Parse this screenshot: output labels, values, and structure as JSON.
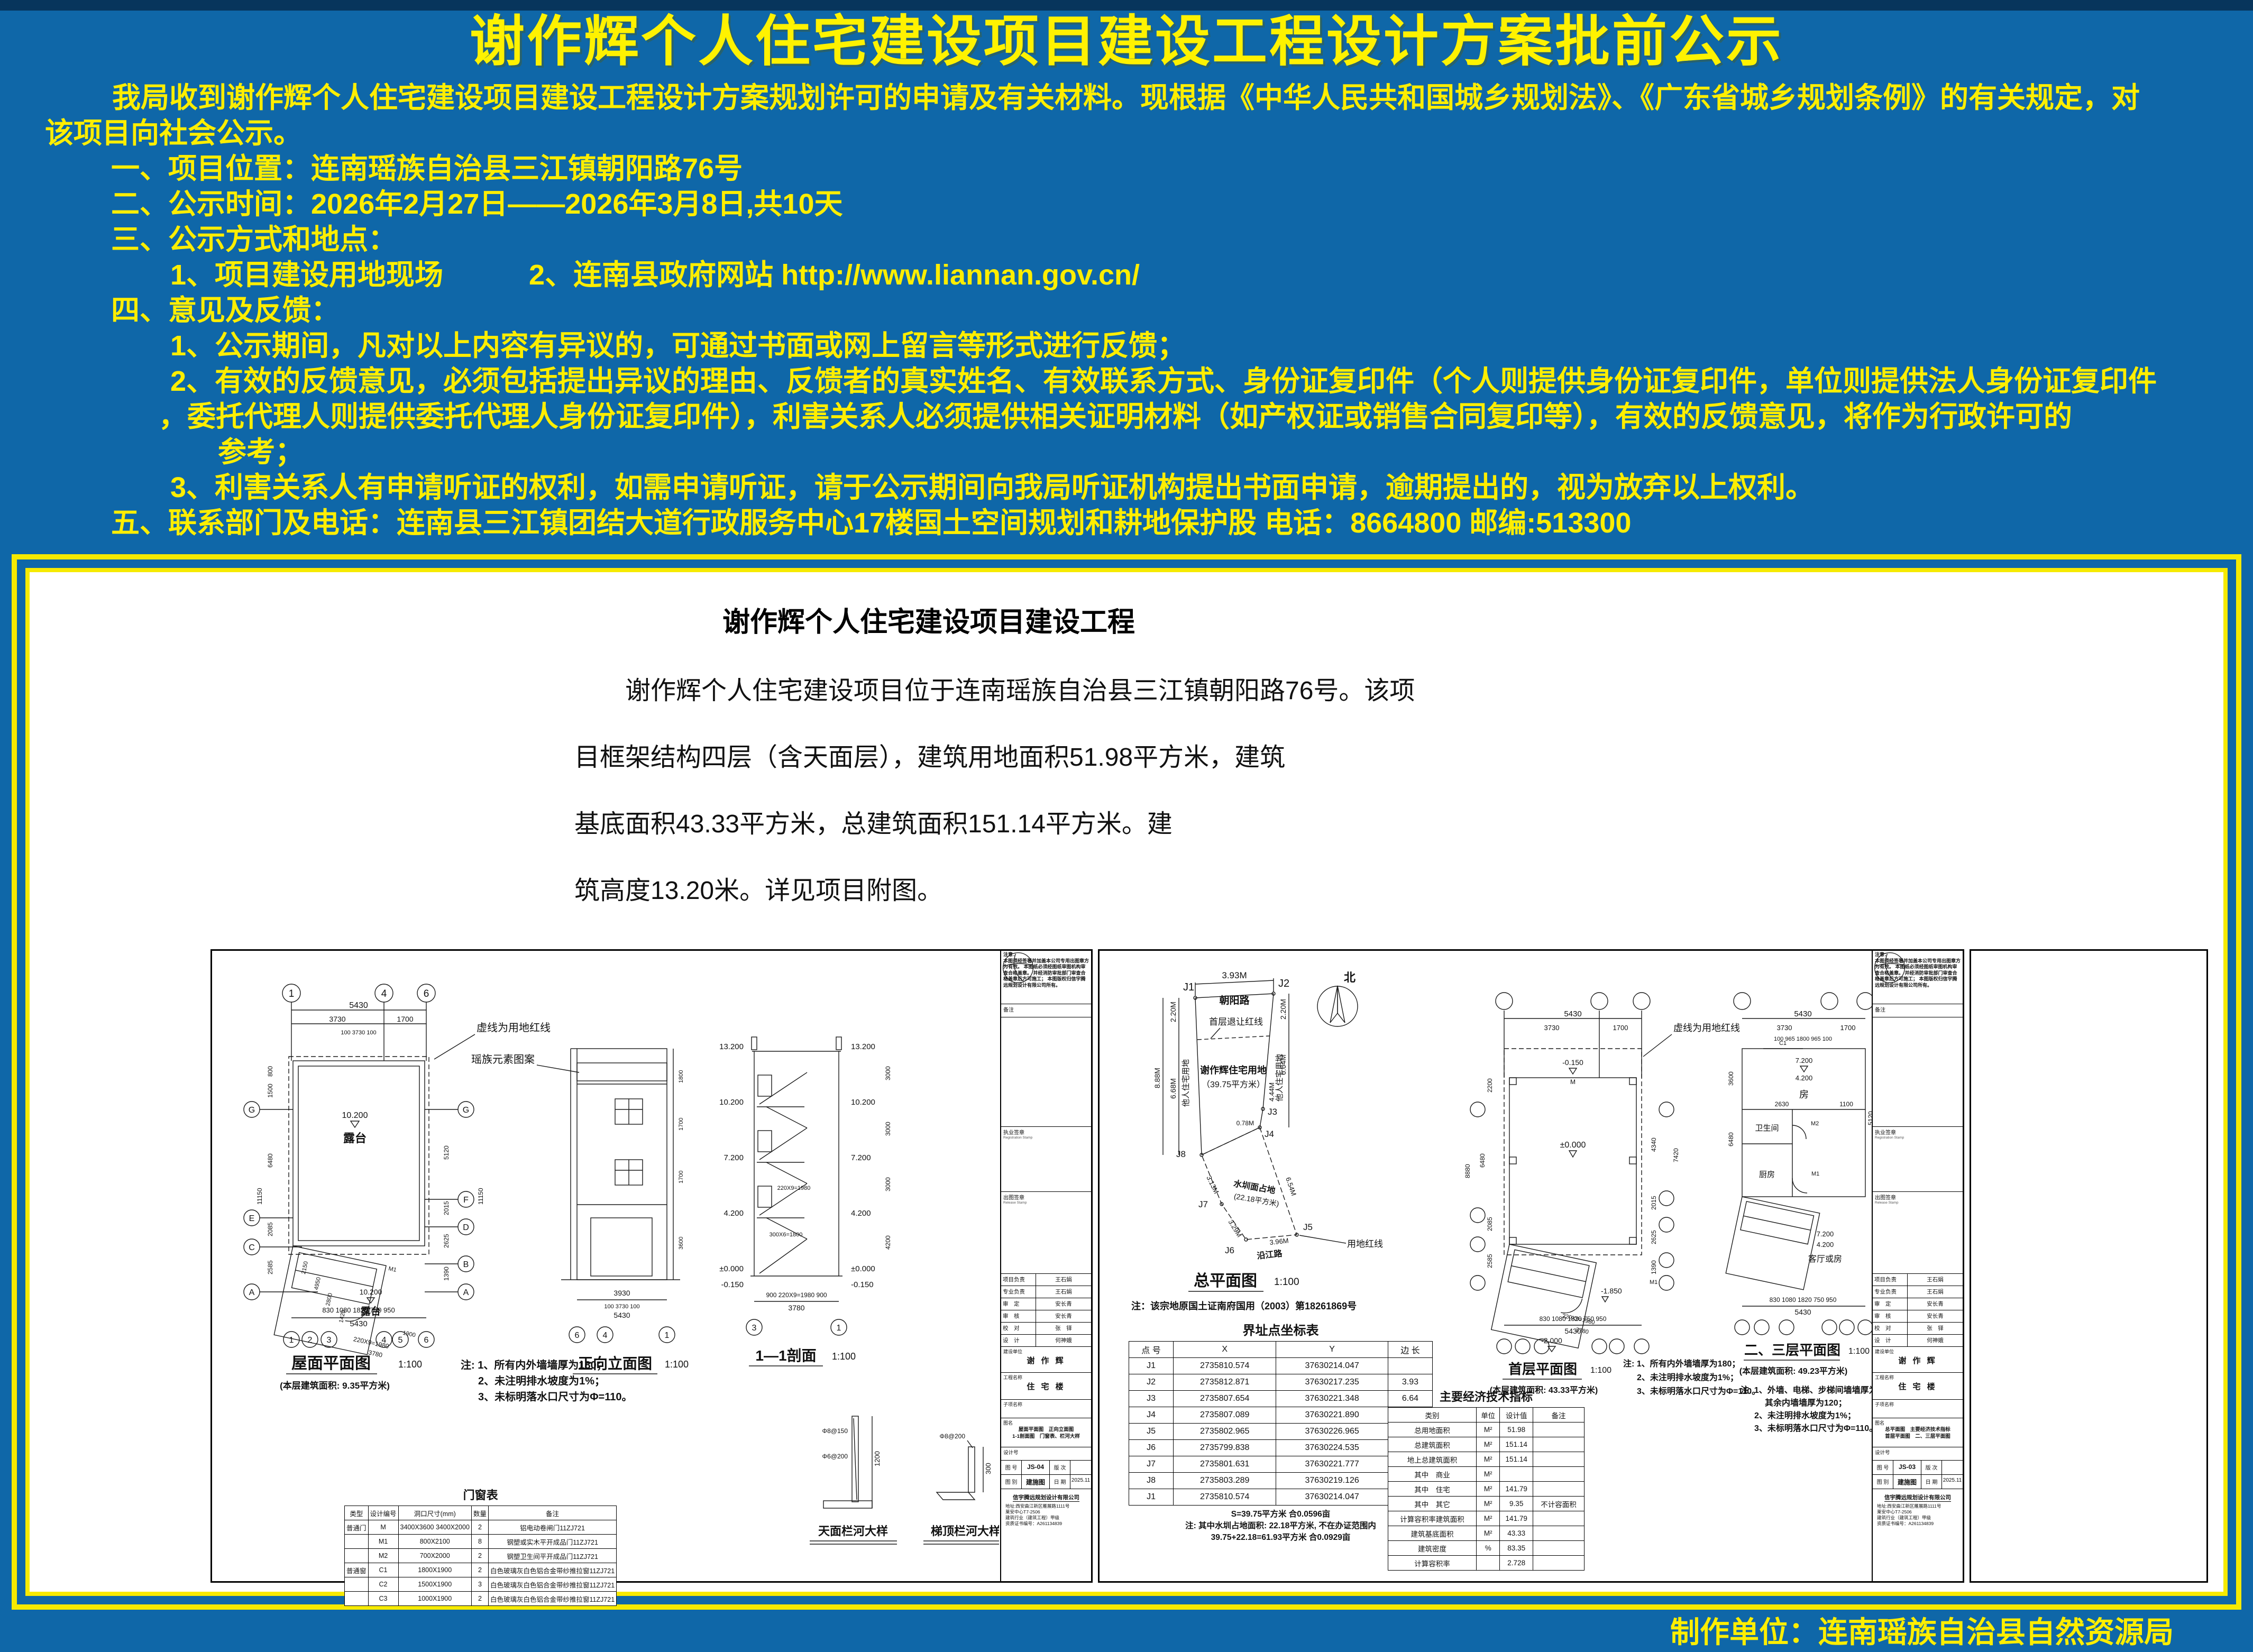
{
  "header": {
    "title": "谢作辉个人住宅建设项目建设工程设计方案批前公示",
    "lines": [
      "我局收到谢作辉个人住宅建设项目建设工程设计方案规划许可的申请及有关材料。现根据《中华人民共和国城乡规划法》、《广东省城乡规划条例》的有关规定，对",
      "该项目向社会公示。",
      "一、项目位置：连南瑶族自治县三江镇朝阳路76号",
      "二、公示时间：2026年2月27日——2026年3月8日,共10天",
      "三、公示方式和地点：",
      "1、项目建设用地现场　　　2、连南县政府网站 http://www.liannan.gov.cn/",
      "四、意见及反馈：",
      "1、公示期间，凡对以上内容有异议的，可通过书面或网上留言等形式进行反馈；",
      "2、有效的反馈意见，必须包括提出异议的理由、反馈者的真实姓名、有效联系方式、身份证复印件（个人则提供身份证复印件，单位则提供法人身份证复印件",
      "，委托代理人则提供委托代理人身份证复印件），利害关系人必须提供相关证明材料（如产权证或销售合同复印等），有效的反馈意见，将作为行政许可的",
      "参考；",
      "3、利害关系人有申请听证的权利，如需申请听证，请于公示期间向我局听证机构提出书面申请，逾期提出的，视为放弃以上权利。",
      "五、联系部门及电话：连南县三江镇团结大道行政服务中心17楼国土空间规划和耕地保护股 电话：8664800 邮编:513300"
    ]
  },
  "panel": {
    "title": "谢作辉个人住宅建设项目建设工程",
    "para": [
      "谢作辉个人住宅建设项目位于连南瑶族自治县三江镇朝阳路76号。该项",
      "目框架结构四层（含天面层），建筑用地面积51.98平方米，建筑",
      "基底面积43.33平方米，总建筑面积151.14平方米。建",
      "筑高度13.20米。详见项目附图。"
    ]
  },
  "tbc": {
    "notice_title": "注意：",
    "notice1": "本图须经签署并加盖本公司专用出图章方为有效。",
    "notice2": "本图纸必须经图纸审图机构审查合格盖章。",
    "notice3": "并经消防审批部门审查合格盖章后方可施工；",
    "notice4": "本图版权归信宇腾远规划设计有限公司所有。",
    "remark": "备注",
    "stamp1": "执业签章",
    "stamp1_en": "Registration Stamp",
    "stamp2": "出图签章",
    "stamp2_en": "Release Stamp",
    "sign_rows": [
      [
        "项目负责",
        "王石娟"
      ],
      [
        "专业负责",
        "王石娟"
      ],
      [
        "审　定",
        "安长青"
      ],
      [
        "审　核",
        "安长青"
      ],
      [
        "校　对",
        "张　铎"
      ],
      [
        "设　计",
        "何神娥"
      ]
    ],
    "owner_label": "建设单位",
    "owner": "谢 作 辉",
    "project_label": "工程名称",
    "project": "住 宅 楼",
    "sub_label": "子项名称",
    "name_label": "图名",
    "dno_label": "设计号",
    "no_label": "图 号",
    "ver_label": "版 次",
    "cat_label": "图 别",
    "cat": "建施图",
    "date_label": "日 期",
    "date": "2025.11",
    "company": "信宇腾远规划设计有限公司",
    "addr1": "地址:西安曲江新区雁展路1111号",
    "addr2": "莱安中心T7-2506",
    "addr3": "建筑行业（建筑工程）甲级",
    "addr4": "资质证书编号：A261134839"
  },
  "d": {
    "lx": {
      "axes": {
        "t": [
          "1",
          "4",
          "6"
        ],
        "b": [
          "1",
          "2",
          "3",
          "4",
          "5",
          "6"
        ],
        "l": [
          "G",
          "E",
          "C",
          "A"
        ],
        "r": [
          "G",
          "F",
          "D",
          "B",
          "A"
        ],
        "e": [
          "6",
          "4",
          "1"
        ],
        "s": [
          "3",
          "1"
        ]
      },
      "roof": {
        "title": "屋面平面图",
        "scale": "1:100",
        "area": "(本层建筑面积: 9.35平方米)",
        "n0": "注: 1、所有内外墙墙厚为180；",
        "n1": "2、未注明排水坡度为1%；",
        "n2": "3、未标明落水口尺寸为Φ=110。",
        "red": "虚线为用地红线",
        "lvl": "10.200",
        "ter": "露台",
        "m1": "M1",
        "d5430": "5430",
        "d3730": "3730",
        "d1700": "1700",
        "drow": "100    3730    100",
        "bot": "830  1080  1820  750  950",
        "bot2": "5430",
        "l800": "800",
        "l1500": "1500",
        "l6480": "6480",
        "l11150": "11150",
        "l2085": "2085",
        "l2585": "2585",
        "r5120": "5120",
        "r2015": "2015",
        "r2625": "2625",
        "r1390": "1390",
        "r11150": "11150",
        "s220": "220X9=1980",
        "s1900": "1900",
        "s3780": "3780",
        "s2150": "2150",
        "s4950": "4950",
        "s2800": "2800",
        "s1420": "1420"
      },
      "elev": {
        "title": "正向立面图",
        "scale": "1:100",
        "pat": "瑶族元素图案",
        "d3930": "3930",
        "drow": "100      3730      100",
        "d5430": "5430",
        "r1": "1800",
        "r2": "1700",
        "r3": "1700",
        "r4": "3600"
      },
      "sec": {
        "title": "1—1剖面",
        "scale": "1:100",
        "lv": [
          "13.200",
          "10.200",
          "7.200",
          "4.200",
          "±0.000",
          "-0.150"
        ],
        "s1": "3000",
        "s2": "3000",
        "s3": "3000",
        "s4": "4200",
        "i1": "220X9=1980",
        "i2": "300X6=1800",
        "b1": "900   220X9=1980   900",
        "b2": "3780"
      },
      "det": {
        "t1": "天面栏河大样",
        "t2": "梯顶栏河大样",
        "h1": "1200",
        "h2": "300",
        "r1": "Φ8@150",
        "r2": "Φ6@200",
        "r3": "Φ8@200"
      },
      "win_title": "门窗表",
      "win_table": [
        [
          "类型",
          "设计编号",
          "洞口尺寸(mm)",
          "数量",
          "备注"
        ],
        [
          "普通门",
          "M",
          "3400X3600 3400X2000",
          "2",
          "铝电动卷闸门11ZJ721"
        ],
        [
          "",
          "M1",
          "800X2100",
          "8",
          "钢塑或实木平开成品门11ZJ721"
        ],
        [
          "",
          "M2",
          "700X2000",
          "2",
          "钢塑卫生间平开成品门11ZJ721"
        ],
        [
          "普通窗",
          "C1",
          "1800X1900",
          "2",
          "白色玻璃灰白色铝合金带纱推拉窗11ZJ721"
        ],
        [
          "",
          "C2",
          "1500X1900",
          "3",
          "白色玻璃灰白色铝合金带纱推拉窗11ZJ721"
        ],
        [
          "",
          "C3",
          "1000X1900",
          "2",
          "白色玻璃灰白色铝合金带纱推拉窗11ZJ721"
        ]
      ],
      "tb": {
        "name1": "屋面平面图　正向立面图",
        "name2": "1-1剖面图　门窗表、栏河大样",
        "no": "JS-04"
      }
    },
    "rx": {
      "site": {
        "title": "总平面图",
        "scale": "1:100",
        "note": "注：该宗地原国土证南府国用（2003）第18261869号",
        "north": "北",
        "road1": "朝阳路",
        "road2": "沿江路",
        "setback": "首层退让红线",
        "owner1": "谢作辉住宅用地",
        "owner2": "（39.75平方米）",
        "otherL": "他人住宅用地",
        "otherR": "他人住宅用地",
        "water1": "水圳面占地",
        "water2": "(22.18平方米)",
        "red": "用地红线",
        "j": [
          "J1",
          "J2",
          "J3",
          "J4",
          "J5",
          "J6",
          "J7",
          "J8"
        ],
        "da": "3.93M",
        "db": "2.20M",
        "dc": "2.20M",
        "dd": "8.88M",
        "de": "6.68M",
        "df": "6.64M",
        "dg": "4.44M",
        "dh": "0.78M",
        "di": "6.54M",
        "dk": "3.96M",
        "dl": "3.29M",
        "dm": "3.13M"
      },
      "coord_title": "界址点坐标表",
      "coord_table": [
        [
          "点 号",
          "X",
          "Y",
          "边 长"
        ],
        [
          "J1",
          "2735810.574",
          "37630214.047",
          ""
        ],
        [
          "J2",
          "2735812.871",
          "37630217.235",
          "3.93"
        ],
        [
          "J3",
          "2735807.654",
          "37630221.348",
          "6.64"
        ],
        [
          "J4",
          "2735807.089",
          "37630221.890",
          "0.78"
        ],
        [
          "J5",
          "2735802.965",
          "37630226.965",
          "6.54"
        ],
        [
          "J6",
          "2735799.838",
          "37630224.535",
          "3.96"
        ],
        [
          "J7",
          "2735801.631",
          "37630221.777",
          "3.29"
        ],
        [
          "J8",
          "2735803.289",
          "37630219.126",
          "3.13"
        ],
        [
          "J1",
          "2735810.574",
          "37630214.047",
          "8.88"
        ]
      ],
      "coord_sum0": "S=39.75平方米  合0.0596亩",
      "coord_sum1": "注: 其中水圳占地面积: 22.18平方米, 不在办证范围内",
      "coord_sum2": "39.75+22.18=61.93平方米  合0.0929亩",
      "f1": {
        "title": "首层平面图",
        "scale": "1:100",
        "area": "(本层建筑面积: 43.33平方米)",
        "n0": "注: 1、所有内外墙墙厚为180；",
        "n1": "2、未注明排水坡度为1%；",
        "n2": "3、未标明落水口尺寸为Φ=110。",
        "red": "虚线为用地红线",
        "lv0": "±0.000",
        "lv1": "-0.150",
        "lv2": "-1.850",
        "lv3": "-2.000",
        "m": "M",
        "m1": "M1",
        "t1": "5430",
        "t2": "3730",
        "t3": "1700",
        "bot": "830  1080  1820  750  950",
        "b2": "5430",
        "l1": "8880",
        "l2": "6480",
        "l3": "2200",
        "l4": "2085",
        "l5": "2585",
        "r1": "7420",
        "r2": "4340",
        "r3": "2015",
        "r4": "2625",
        "r5": "1390",
        "s1": "220X9=1980",
        "s2": "3780"
      },
      "f23": {
        "title": "二、三层平面图",
        "scale": "1:100",
        "area": "(本层建筑面积: 49.23平方米)",
        "n0": "注: 1、外墙、电梯、步梯间墙墙厚为180；",
        "n0b": "其余内墙墙厚为120；",
        "n1": "2、未注明排水坡度为1%；",
        "n2": "3、未标明落水口尺寸为Φ=110。",
        "red": "虚线为用地红线",
        "room1": "房",
        "room2": "卫生间",
        "room3": "厨房",
        "room4": "客厅或房",
        "lvA": "7.200",
        "lvB": "4.200",
        "c1": "C1",
        "m1": "M1",
        "m2": "M2",
        "t1": "5430",
        "t2": "3730",
        "t3": "1700",
        "t4": "100 965 1800 965 100",
        "bot": "830  1080  1820  750  950",
        "b2": "5430",
        "i1": "2630",
        "i2": "1100",
        "l1": "6480",
        "l2": "3600",
        "r1": "5120",
        "r2": "11150"
      },
      "econ_title": "主要经济技术指标",
      "econ_table": [
        [
          "类别",
          "单位",
          "设计值",
          "备注"
        ],
        [
          "总用地面积",
          "M²",
          "51.98",
          ""
        ],
        [
          "总建筑面积",
          "M²",
          "151.14",
          ""
        ],
        [
          "地上总建筑面积",
          "M²",
          "151.14",
          ""
        ],
        [
          "其中　商业",
          "M²",
          "",
          ""
        ],
        [
          "其中　住宅",
          "M²",
          "141.79",
          ""
        ],
        [
          "其中　其它",
          "M²",
          "9.35",
          "不计容面积"
        ],
        [
          "计算容积率建筑面积",
          "M²",
          "141.79",
          ""
        ],
        [
          "建筑基底面积",
          "M²",
          "43.33",
          ""
        ],
        [
          "建筑密度",
          "%",
          "83.35",
          ""
        ],
        [
          "计算容积率",
          "",
          "2.728",
          ""
        ]
      ],
      "tb": {
        "name1": "总平面图　主要经济技术指标",
        "name2": "首层平面图　二、三层平面图",
        "no": "JS-03"
      }
    }
  },
  "credit": "制作单位：连南瑶族自治县自然资源局"
}
